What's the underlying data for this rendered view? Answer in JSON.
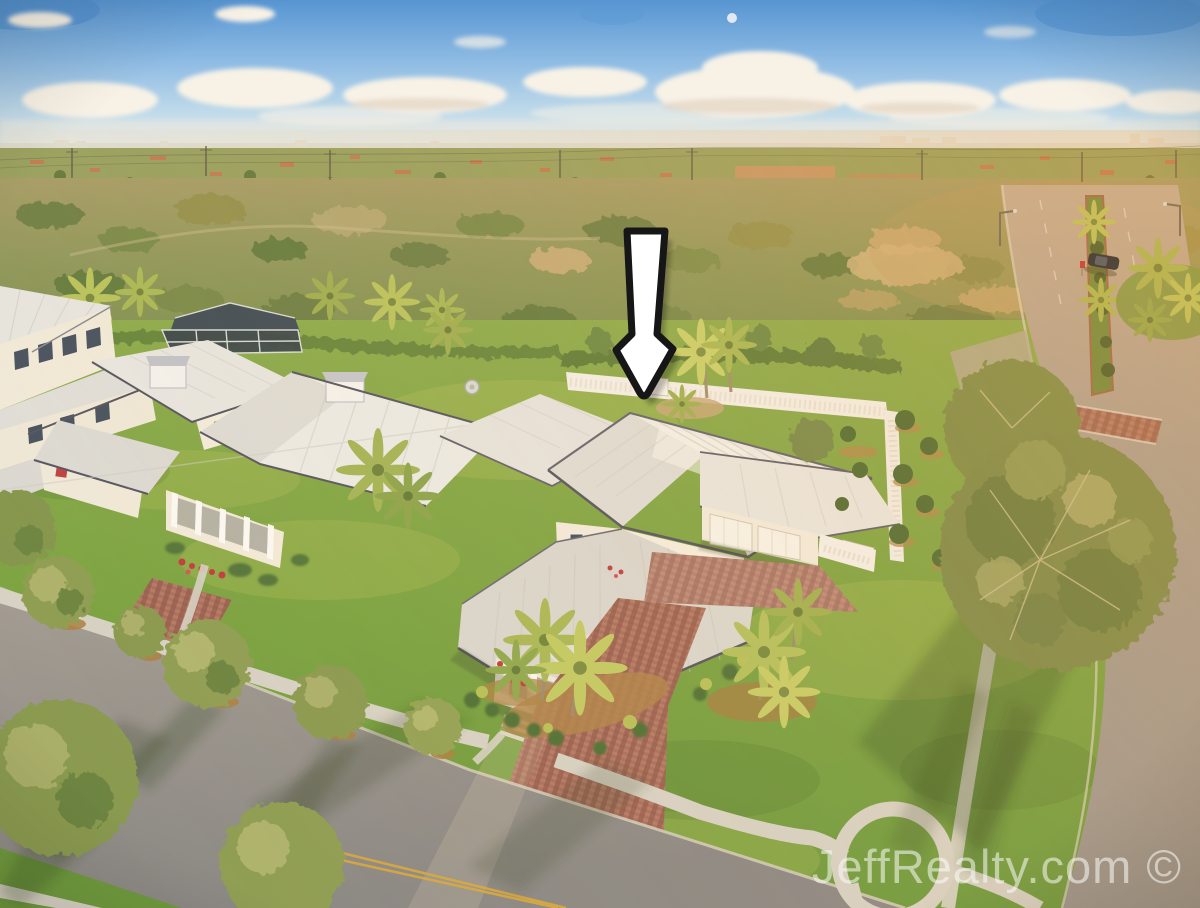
{
  "watermark": {
    "text": "JeffRealty.com ©",
    "color": "rgba(252,252,250,0.55)"
  },
  "icons": {
    "marker": "down-arrow-icon"
  },
  "colors": {
    "arrow_fill": "#ffffff",
    "arrow_outline": "#161616",
    "sky_top": "#5795d2",
    "sky_horizon": "#efe8d6",
    "cloud": "#f8f2e6",
    "roof_white": "#eceae3",
    "wall_cream": "#f3ecdd",
    "lawn_green": "#7ba341",
    "scrub_olive": "#9c9a62",
    "paver_brick": "#a86f5e",
    "asphalt": "#94908b",
    "concrete": "#d7d2c5",
    "centerline_yellow": "#d9a93c",
    "fence_white": "#f4f1ea"
  }
}
